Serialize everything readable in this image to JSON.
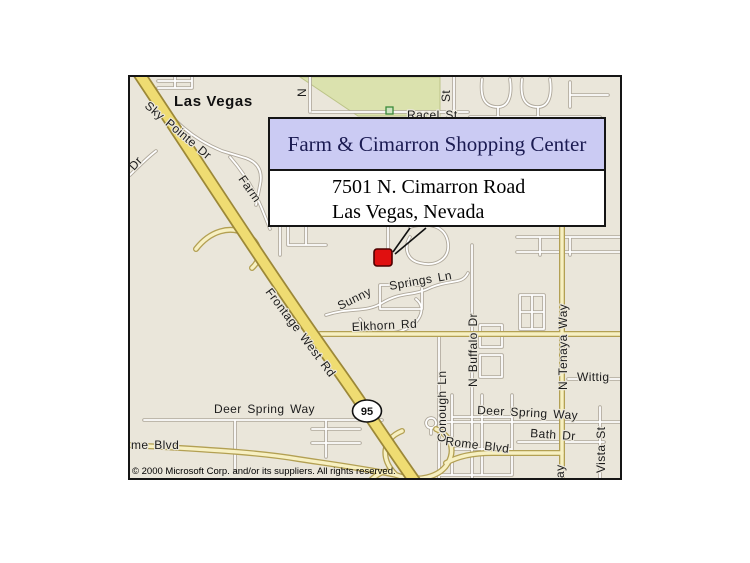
{
  "callout": {
    "title": "Farm & Cimarron Shopping Center",
    "address_line1": "7501 N. Cimarron Road",
    "address_line2": "Las Vegas, Nevada"
  },
  "map": {
    "city_label": "Las Vegas",
    "highway_shield": "95",
    "copyright": "© 2000 Microsoft Corp. and/or its suppliers. All rights reserved.",
    "streets": {
      "sky_pointe": "Sky Pointe Dr",
      "partial_dr": "Dr",
      "farm": "Farm",
      "racel": "Racel St",
      "partial_n": "N",
      "partial_st": "St",
      "sunny": "Sunny",
      "springs_ln": "Springs Ln",
      "elkhorn": "Elkhorn Rd",
      "frontage": "Frontage West Rd",
      "conough": "Conough Ln",
      "n_buffalo": "N Buffalo Dr",
      "n_tenaya": "N Tenaya Way",
      "partial_way": "ay",
      "wittig": "Wittig",
      "deer_spring_left": "Deer Spring Way",
      "deer_spring_right": "Deer Spring Way",
      "bath": "Bath Dr",
      "rome_left": "me Blvd",
      "rome_right": "Rome Blvd",
      "vista": "Vista St"
    },
    "colors": {
      "map_bg": "#EAE6DA",
      "park_fill": "#DBE2AE",
      "park_edge": "#BCC488",
      "road_casing": "#AFA89B",
      "road_fill": "#FFFFFF",
      "yellow_casing": "#B3A053",
      "yellow_fill": "#F7F0C2",
      "highway_casing": "#9C8838",
      "highway_fill": "#EFDC72",
      "callout_header_bg": "#CBCBF3",
      "callout_title_color": "#1B1B52",
      "marker_red": "#E01010",
      "frame_border": "#151515"
    }
  }
}
